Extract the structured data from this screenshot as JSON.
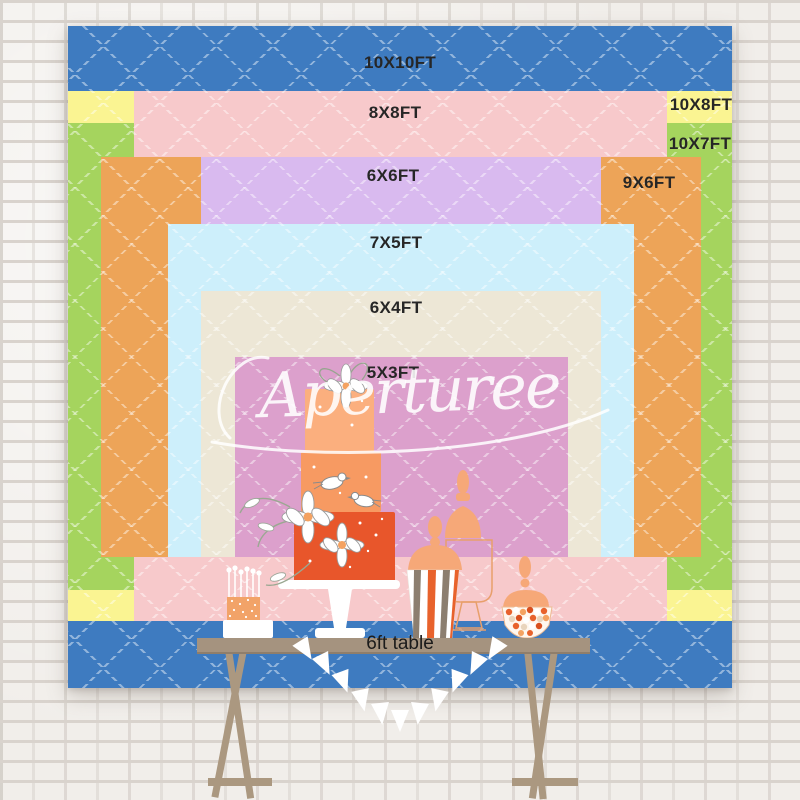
{
  "sizes": [
    {
      "label": "10X10FT",
      "color": "#3E7BC0"
    },
    {
      "label": "8X8FT",
      "color": "#F7C9CB"
    },
    {
      "label": "10X8FT",
      "color": "#FAF492"
    },
    {
      "label": "10X7FT",
      "color": "#A5D45E"
    },
    {
      "label": "6X6FT",
      "color": "#D9BAEF"
    },
    {
      "label": "9X6FT",
      "color": "#EDA458"
    },
    {
      "label": "7X5FT",
      "color": "#CDEFFB"
    },
    {
      "label": "6X4FT",
      "color": "#EDE7D6"
    },
    {
      "label": "5X3FT",
      "color": "#DCA0CC"
    }
  ],
  "table": {
    "label": "6ft table",
    "color": "#A5937F"
  },
  "watermark": {
    "text": "Aperturee",
    "color": "#FFFFFF"
  },
  "scene": {
    "wall": "white-brick-wall",
    "pattern": "white-dashed-diamond-quilt",
    "illustrations": [
      "three-tier-cake",
      "candle-cake",
      "apothecary-jar",
      "popcorn-jar",
      "confetti-candy-bowl",
      "bunting-flags",
      "trestle-table"
    ]
  }
}
